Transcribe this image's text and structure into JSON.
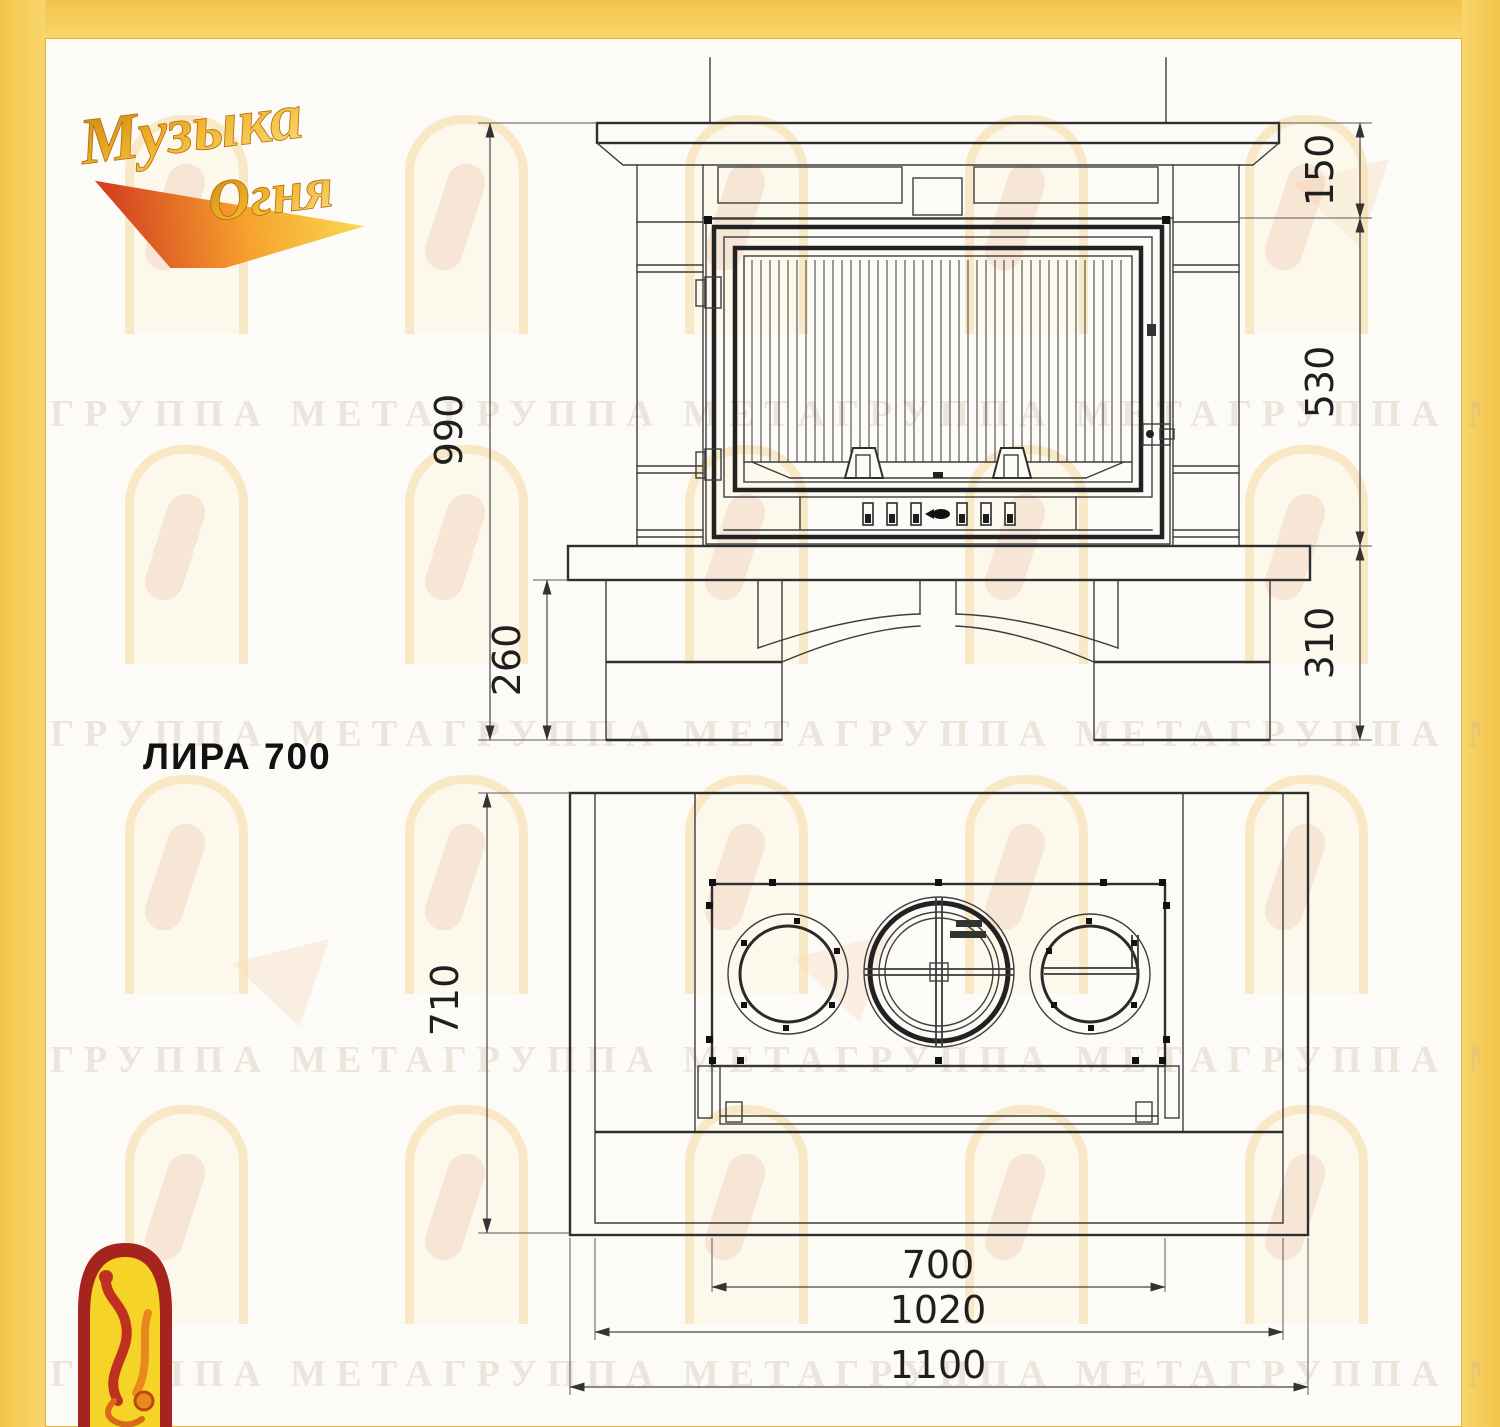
{
  "branding": {
    "logo_top": {
      "line1": "Музыка",
      "line2": "Огня"
    },
    "watermark_text": "ГРУППА МЕТАГРУППА МЕТАГРУППА МЕТАГРУППА МЕТАГРУППА МЕТА"
  },
  "drawing": {
    "model_label": "ЛИРА 700",
    "front_view": {
      "dims": {
        "overall_height": "990",
        "mantel_zone": "150",
        "firebox_zone": "530",
        "base_zone": "310",
        "hearth_zone": "260"
      }
    },
    "plan_view": {
      "dims": {
        "depth": "710",
        "firebox_width": "700",
        "plinth_width": "1020",
        "overall_width": "1100"
      }
    }
  },
  "colors": {
    "frame_yellow": "#F6CC55",
    "sheet_white": "#FCFBF7",
    "line_dark": "#333333",
    "logo_red": "#A6241E",
    "logo_gold": "#E9A51F"
  }
}
